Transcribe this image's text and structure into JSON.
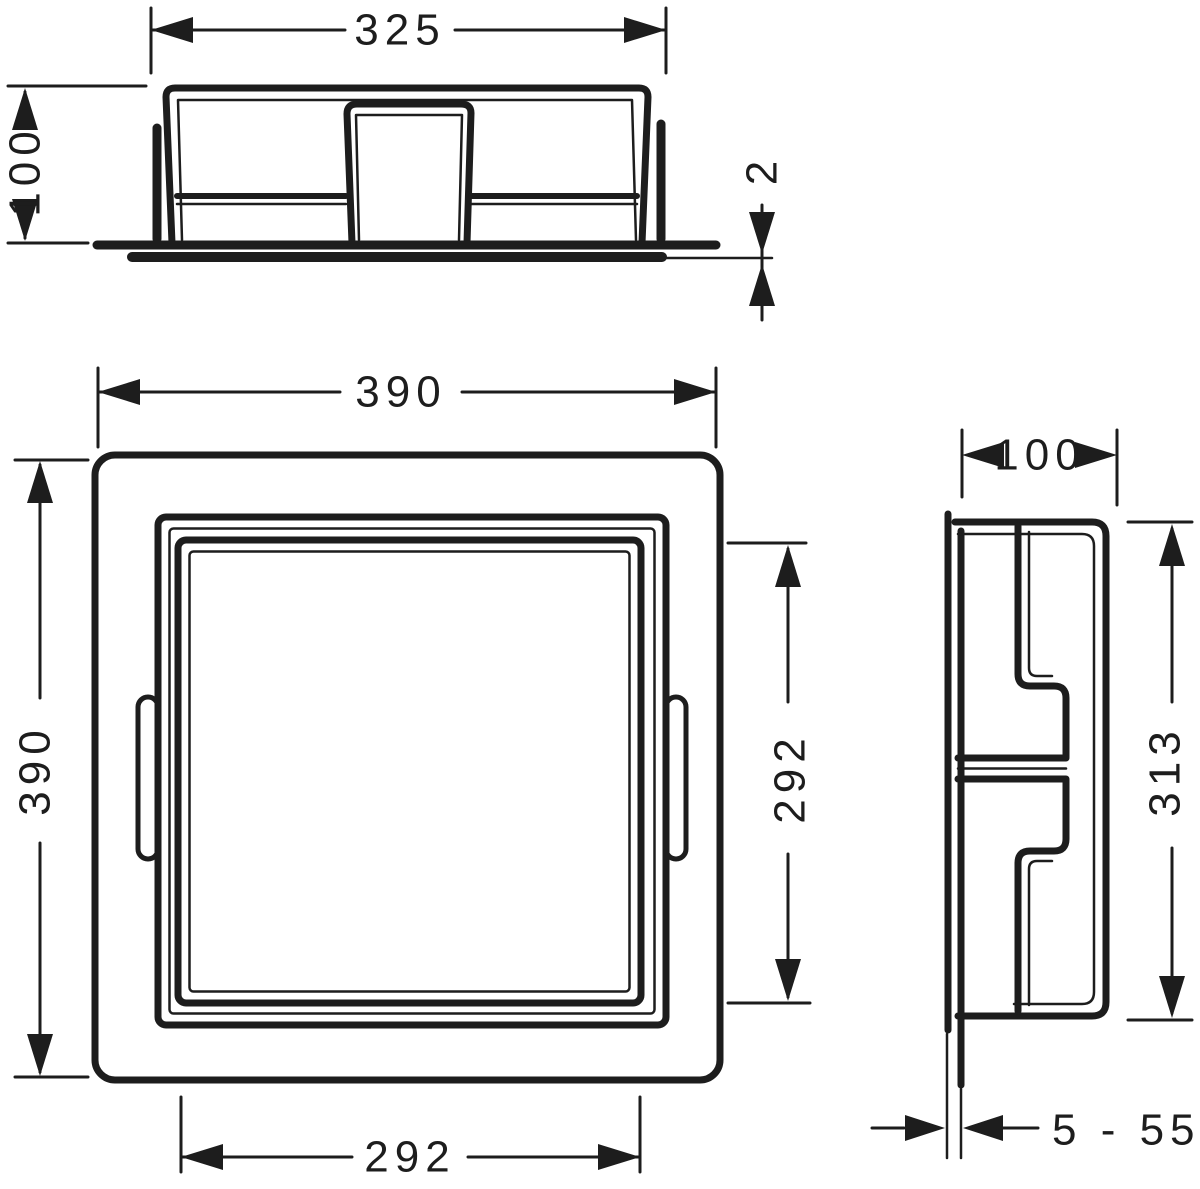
{
  "colors": {
    "line": "#1d1d1d",
    "background": "#ffffff"
  },
  "views": {
    "top": {
      "dims": {
        "width": "325",
        "height": "100",
        "frame_thickness": "2"
      }
    },
    "front": {
      "dims": {
        "outer_width": "390",
        "outer_height": "390",
        "opening_width": "292",
        "opening_height": "292"
      }
    },
    "side": {
      "dims": {
        "depth": "100",
        "height": "313",
        "tile_range": "5 - 55"
      }
    }
  }
}
